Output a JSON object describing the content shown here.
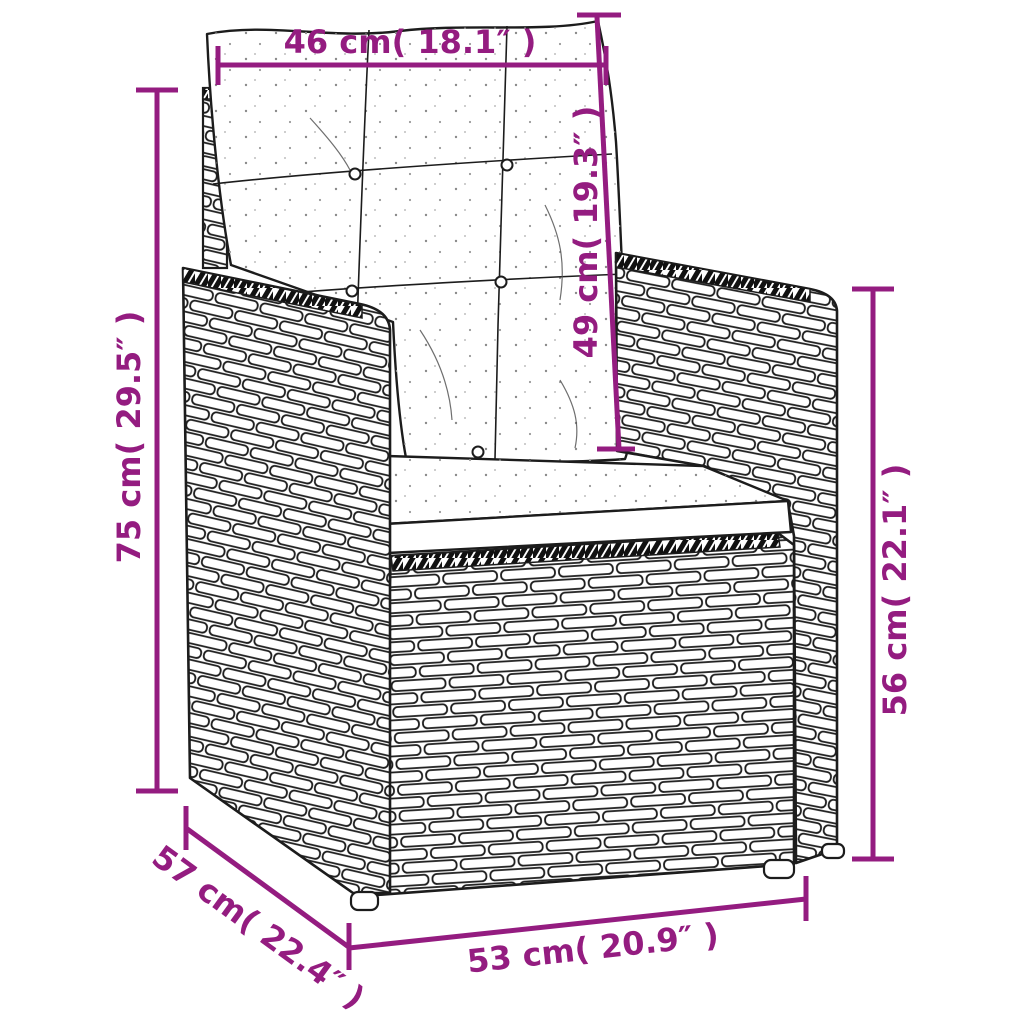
{
  "image": {
    "type": "product-dimension-diagram",
    "subject": "poly rattan garden armchair with tufted back cushion and seat cushion"
  },
  "colors": {
    "accent": "#941C80",
    "ink": "#1C1C1C",
    "background": "#FFFFFF"
  },
  "dimensions": {
    "back_cushion_width": {
      "label": "46 cm( 18.1″ )"
    },
    "back_cushion_height": {
      "label": "49 cm( 19.3″ )"
    },
    "total_height": {
      "label": "75 cm( 29.5″ )"
    },
    "armrest_height": {
      "label": "56 cm( 22.1″ )"
    },
    "depth": {
      "label": "57 cm( 22.4″ )"
    },
    "seat_width": {
      "label": "53 cm( 20.9″ )"
    }
  }
}
